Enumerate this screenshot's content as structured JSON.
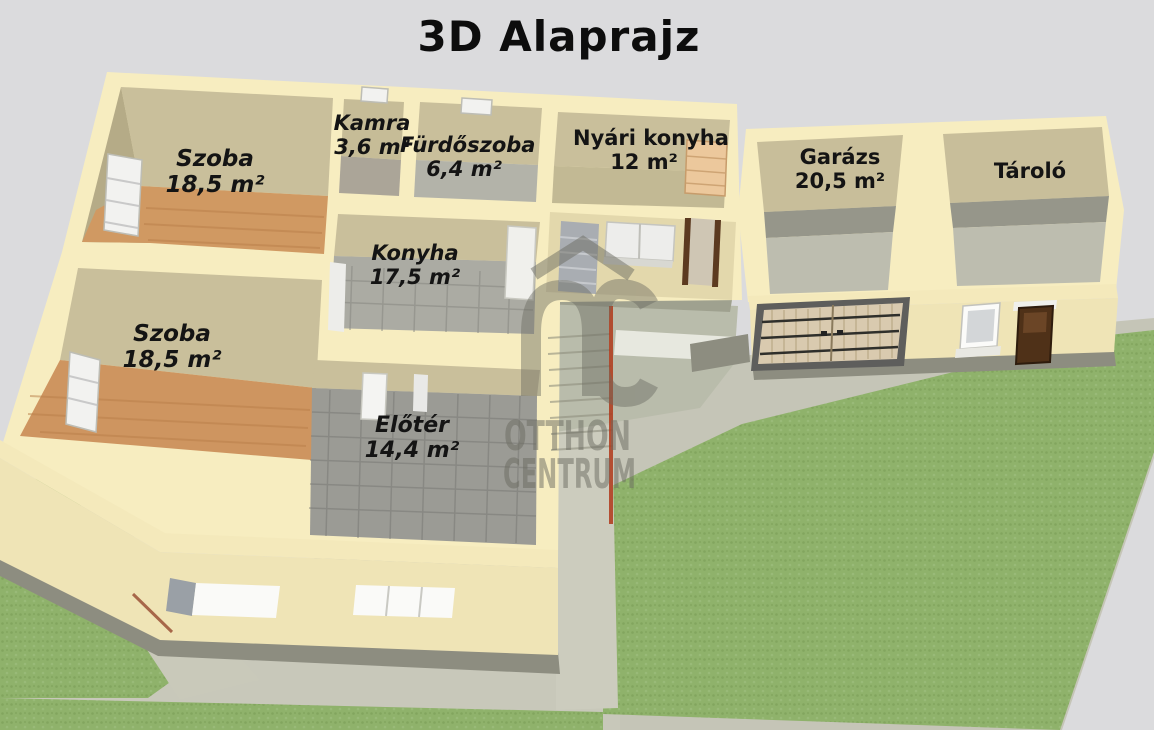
{
  "title": "3D Alaprajz",
  "watermark": {
    "logo": "OC",
    "line1": "OTTHON",
    "line2": "CENTRUM"
  },
  "rooms": {
    "szoba1": {
      "name": "Szoba",
      "area": "18,5 m²"
    },
    "kamra": {
      "name": "Kamra",
      "area": "3,6 m²"
    },
    "furdoszoba": {
      "name": "Fürdőszoba",
      "area": "6,4 m²"
    },
    "nyari_konyha": {
      "name": "Nyári konyha",
      "area": "12 m²"
    },
    "garazs": {
      "name": "Garázs",
      "area": "20,5 m²"
    },
    "tarolo": {
      "name": "Tároló"
    },
    "konyha": {
      "name": "Konyha",
      "area": "17,5 m²"
    },
    "szoba2": {
      "name": "Szoba",
      "area": "18,5 m²"
    },
    "eloter": {
      "name": "Előtér",
      "area": "14,4 m²"
    }
  },
  "colors": {
    "background": "#DBDBDD",
    "wall_cream": "#F7EDC0",
    "facade_cream": "#EFE4B6",
    "wall_tan": "#C9BF9B",
    "wood_floor": "#D09962",
    "tile_gray": "#9B9B95",
    "concrete": "#C5C5B7",
    "grass": "#8FB26B",
    "shadow": "#8D8D80",
    "label_text": "#141414",
    "watermark_gray": "#6B6B61",
    "accent_red": "#B0391A"
  }
}
